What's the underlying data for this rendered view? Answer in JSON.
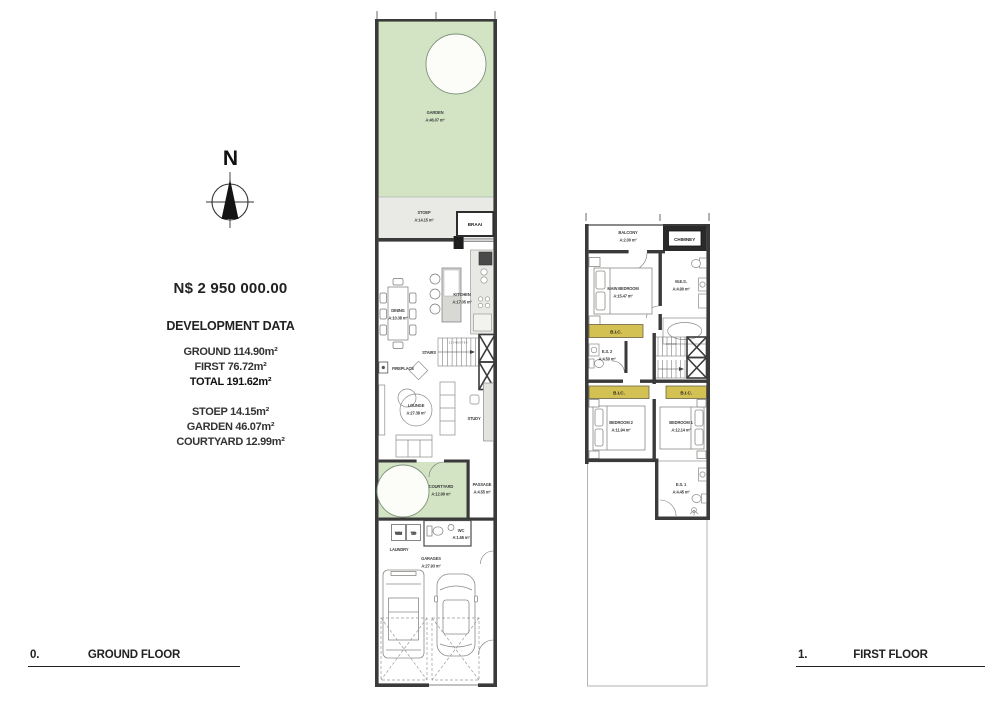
{
  "info": {
    "north_letter": "N",
    "price": "N$ 2 950 000.00",
    "dev_title": "DEVELOPMENT DATA",
    "area_lines": [
      "GROUND 114.90m²",
      "FIRST 76.72m²",
      "TOTAL 191.62m²"
    ],
    "outdoor_lines": [
      "STOEP 14.15m²",
      "GARDEN 46.07m²",
      "COURTYARD 12.99m²"
    ]
  },
  "footer": {
    "ground_number": "0.",
    "ground_title": "GROUND FLOOR",
    "first_number": "1.",
    "first_title": "FIRST FLOOR"
  },
  "colors": {
    "wall": "#3a3a3a",
    "garden_green": "#d3e4c4",
    "stoep_grey": "#e9e9e6",
    "bic_yellow": "#d4c153"
  },
  "ground": {
    "garden": {
      "name": "GARDEN",
      "area": "A:46.07 m²"
    },
    "stoep": {
      "name": "STOEP",
      "area": "A:14.15 m²"
    },
    "braai": {
      "name": "BRAAI"
    },
    "kitchen": {
      "name": "KITCHEN",
      "area": "A:17.05 m²"
    },
    "dining": {
      "name": "DINING",
      "area": "A:10.38 m²"
    },
    "stairs": {
      "name": "STAIRS"
    },
    "stair_numbers": "1 2 3 4 5 6 7 8 9",
    "fireplace": {
      "name": "FIREPLACE"
    },
    "lounge": {
      "name": "LOUNGE",
      "area": "A:27.38 m²"
    },
    "study": {
      "name": "STUDY"
    },
    "courtyard": {
      "name": "COURTYARD",
      "area": "A:12.99 m²"
    },
    "passage": {
      "name": "PASSAGE",
      "area": "A:4.55 m²"
    },
    "laundry": {
      "name": "LAUNDRY"
    },
    "wm": "W/M",
    "td": "T/D",
    "wc": {
      "name": "WC",
      "area": "A:1.65 m²"
    },
    "garages": {
      "name": "GARAGES",
      "area": "A:27.93 m²"
    }
  },
  "first": {
    "balcony": {
      "name": "BALCONY",
      "area": "A:2.00 m²"
    },
    "chimney": {
      "name": "CHIMNEY"
    },
    "main_bedroom": {
      "name": "MAIN BEDROOM",
      "area": "A:15.47 m²"
    },
    "mes": {
      "name": "M.E.S.",
      "area": "A:4.90 m²"
    },
    "bic": "B.I.C.",
    "es2": {
      "name": "E.S. 2",
      "area": "A:4.50 m²"
    },
    "stair_numbers": "9 8 7 6 5",
    "bedroom2": {
      "name": "BEDROOM 2",
      "area": "A:11.94 m²"
    },
    "bedroom1": {
      "name": "BEDROOM 1",
      "area": "A:12.14 m²"
    },
    "es1": {
      "name": "E.S. 1",
      "area": "A:4.45 m²"
    }
  }
}
